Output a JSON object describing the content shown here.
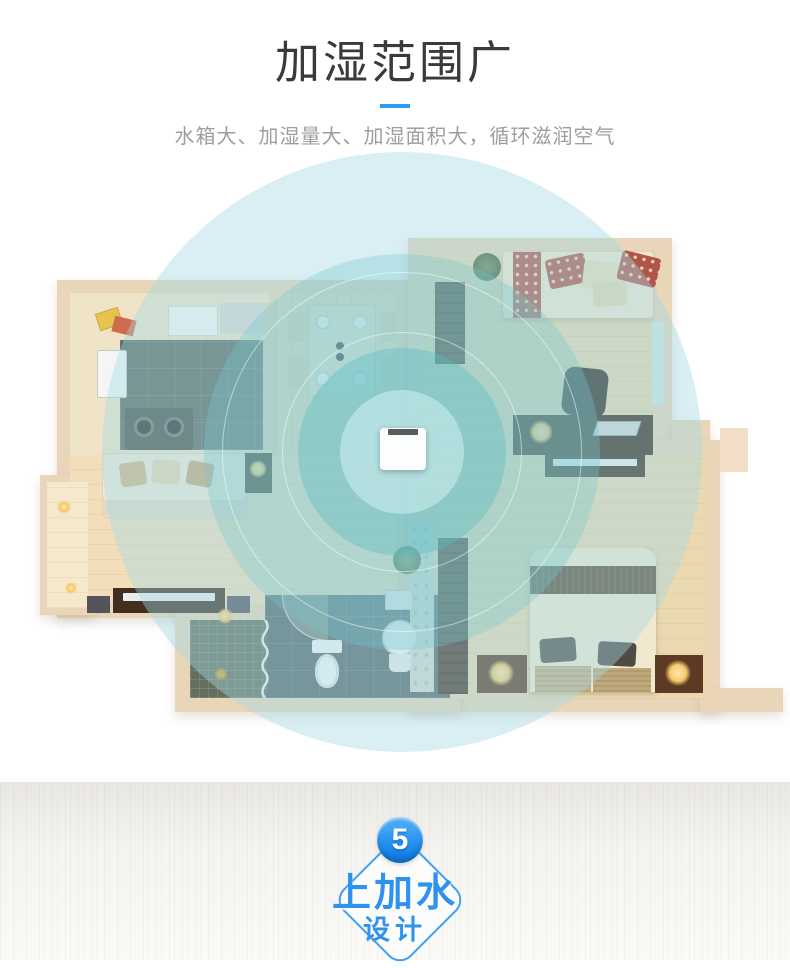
{
  "header": {
    "title": "加湿范围广",
    "subtitle": "水箱大、加湿量大、加湿面积大，循环滋润空气",
    "title_color": "#3a3a3a",
    "subtitle_color": "#9e9e9e",
    "accent_color": "#2b9cf2"
  },
  "floorplan": {
    "device": "humidifier",
    "range_rings": 4,
    "ring_color": "#7cc6ce",
    "wall_color": "#e9d6b8"
  },
  "next_feature": {
    "number": "5",
    "title": "上加水",
    "subtitle": "设计",
    "badge_color": "#2f93ee",
    "circle_color": "#1b8bec"
  }
}
